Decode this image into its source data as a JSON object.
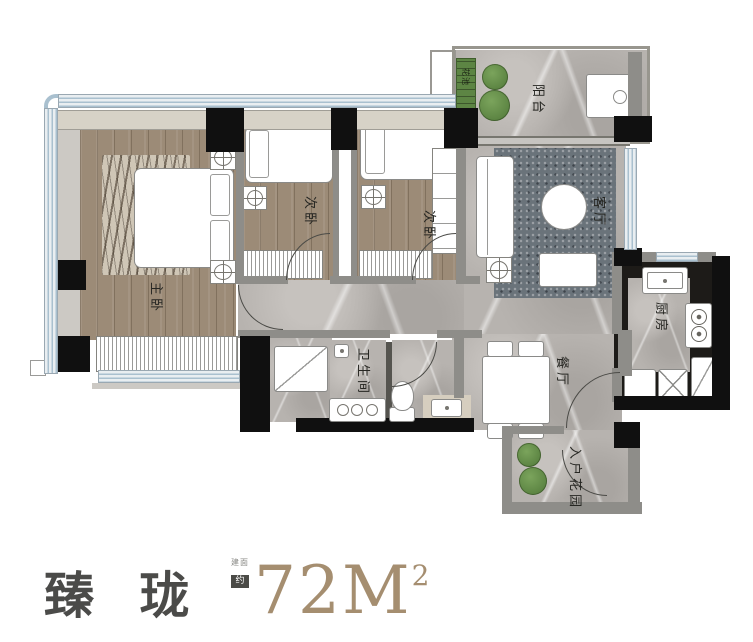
{
  "floor_plan": {
    "rooms": {
      "master_bedroom": {
        "label": "主卧"
      },
      "bedroom_2": {
        "label": "次卧"
      },
      "bedroom_3": {
        "label": "次卧"
      },
      "living_room": {
        "label": "客厅"
      },
      "dining_room": {
        "label": "餐厅"
      },
      "kitchen": {
        "label": "厨房"
      },
      "bathroom": {
        "label": "卫生间"
      },
      "balcony": {
        "label": "阳台"
      },
      "entry_garden": {
        "label": "入户花园"
      },
      "planter_box": {
        "label": "花池"
      }
    }
  },
  "footer": {
    "project_name": "臻 珑",
    "area_prefix": "建面",
    "area_prefix_badge": "约",
    "area_value": "72M",
    "area_exponent": "2"
  },
  "colors": {
    "project_name_text": "#4b4b49",
    "area_text": "#a58e70",
    "wall_black": "#101010",
    "window_blue": "#a9c0cf",
    "wood_floor": "#9c8b77",
    "marble_floor": "#b7b3af",
    "plant_green": "#6b9150",
    "kitchen_counter": "#1d1b18",
    "rug_dark": "#6a737a"
  }
}
